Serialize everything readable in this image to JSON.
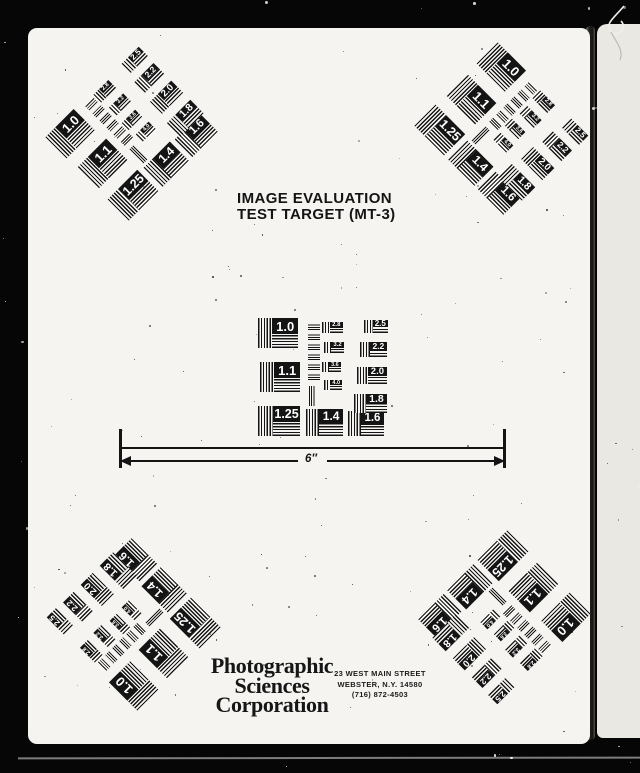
{
  "document": {
    "title_line1": "IMAGE EVALUATION",
    "title_line2": "TEST TARGET (MT-3)",
    "scale_label": "6″",
    "organization": {
      "line1": "Photographic",
      "line2": "Sciences",
      "line3": "Corporation"
    },
    "address": {
      "line1": "23 WEST MAIN STREET",
      "line2": "WEBSTER, N.Y. 14580",
      "line3": "(716) 872-4503"
    }
  },
  "target_pattern": {
    "left_column": [
      "1.0",
      "1.1",
      "1.25"
    ],
    "bottom_row": [
      "1.4",
      "1.6"
    ],
    "right_column": [
      "2.5",
      "2.2",
      "2.0",
      "1.8"
    ],
    "middle_column": [
      "2.8",
      "3.2",
      "3.6",
      "4.0"
    ]
  },
  "colors": {
    "background": "#060606",
    "paper": "#f5f4f1",
    "under_page": "#eae8e3",
    "ink": "#141414"
  }
}
